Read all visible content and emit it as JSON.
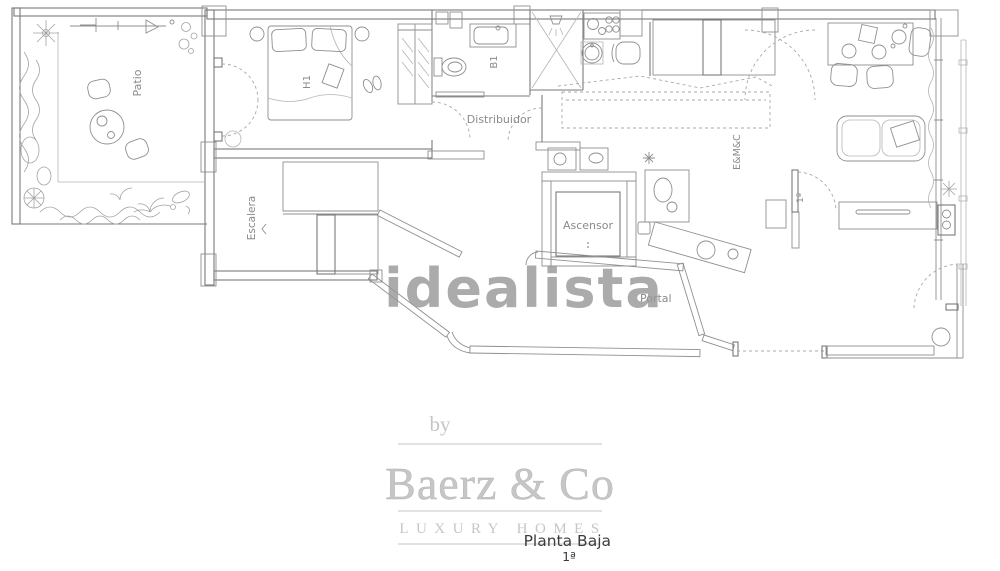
{
  "plan": {
    "label_color": "#8a8a8a",
    "line_color": "#7a7a7a",
    "labels": {
      "patio": "Patio",
      "h1": "H1",
      "b1": "B1",
      "distribuidor": "Distribuidor",
      "escalera": "Escalera",
      "ascensor": "Ascensor",
      "emc": "E&M&C",
      "portal": "Portal",
      "unit_door": "1ª"
    }
  },
  "watermark": {
    "text": "idealista",
    "color": "#979797"
  },
  "branding": {
    "prefix": "by",
    "name": "Baerz & Co",
    "tagline": "LUXURY HOMES",
    "color": "#c6c6c6"
  },
  "caption": {
    "title": "Planta Baja",
    "floor": "1ª",
    "color": "#3c3c3c"
  }
}
